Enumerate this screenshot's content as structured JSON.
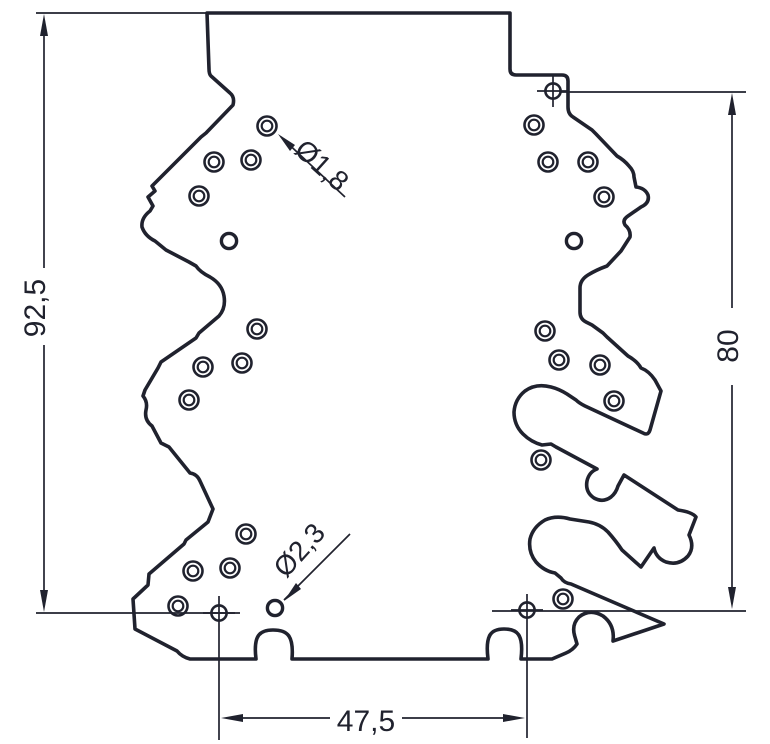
{
  "drawing": {
    "background": "#ffffff",
    "line_color": "#20222e",
    "dimension_labels": {
      "left_height": "92,5",
      "right_height": "80",
      "bottom_width": "47,5"
    },
    "diameter_callouts": {
      "small_hole": "Ø1,8",
      "large_hole": "Ø2,3"
    },
    "holes": {
      "double_ring_radii": [
        9.5,
        5.3
      ],
      "plain_radius": 7.6,
      "datum_radius": 7.6,
      "double_ring": [
        [
          267,
          126
        ],
        [
          214,
          162
        ],
        [
          251,
          160
        ],
        [
          199,
          196
        ],
        [
          257,
          329
        ],
        [
          203,
          367
        ],
        [
          242,
          363
        ],
        [
          189,
          400
        ],
        [
          246,
          534
        ],
        [
          193,
          571
        ],
        [
          230,
          568
        ],
        [
          178,
          606
        ],
        [
          534,
          125
        ],
        [
          548,
          162
        ],
        [
          588,
          162
        ],
        [
          604,
          197
        ],
        [
          545,
          331
        ],
        [
          559,
          360
        ],
        [
          600,
          365
        ],
        [
          614,
          401
        ],
        [
          541,
          460
        ],
        [
          563,
          599
        ]
      ],
      "plain": [
        [
          229,
          241
        ],
        [
          574,
          241
        ],
        [
          275,
          608
        ]
      ],
      "datum": [
        [
          553,
          91
        ],
        [
          219,
          613
        ],
        [
          527,
          610
        ]
      ]
    }
  }
}
